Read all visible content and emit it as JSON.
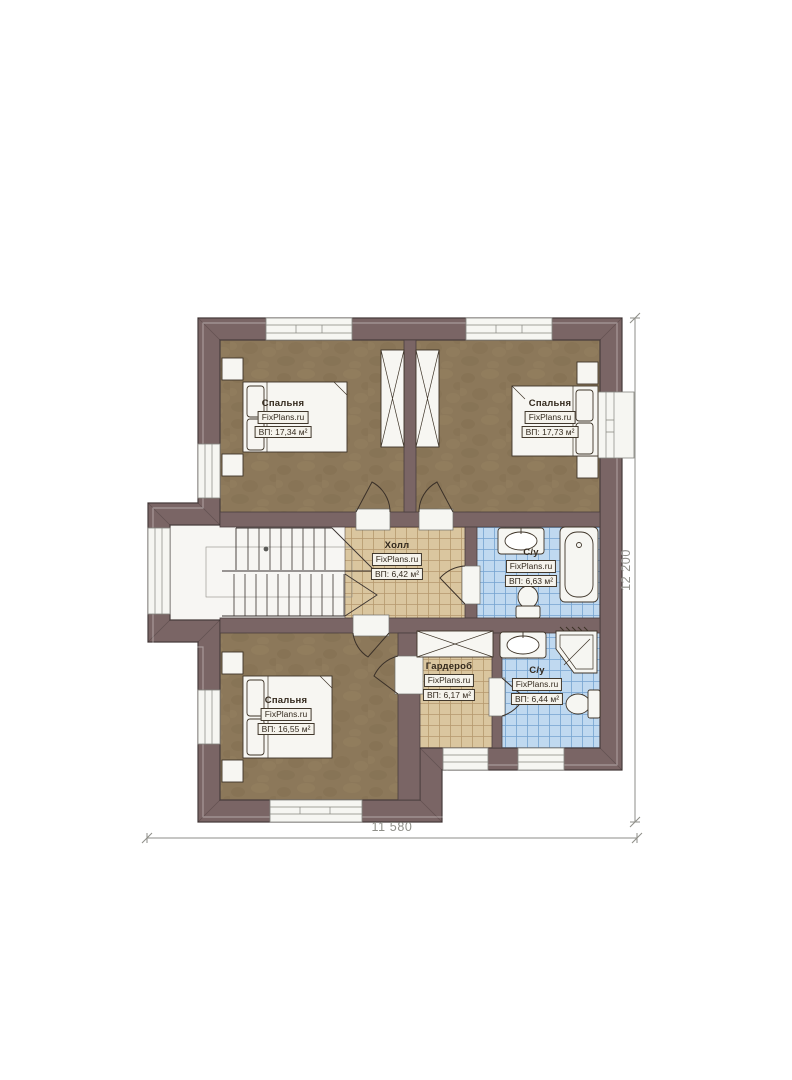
{
  "rooms": [
    {
      "id": "bedroom-top-left",
      "name": "Спальня",
      "brand": "FixPlans.ru",
      "area": "ВП: 17,34 м²"
    },
    {
      "id": "bedroom-top-right",
      "name": "Спальня",
      "brand": "FixPlans.ru",
      "area": "ВП: 17,73 м²"
    },
    {
      "id": "hall",
      "name": "Холл",
      "brand": "FixPlans.ru",
      "area": "ВП: 6,42 м²"
    },
    {
      "id": "bathroom-upper",
      "name": "С/у",
      "brand": "FixPlans.ru",
      "area": "ВП: 6,63 м²"
    },
    {
      "id": "bedroom-bottom",
      "name": "Спальня",
      "brand": "FixPlans.ru",
      "area": "ВП: 16,55 м²"
    },
    {
      "id": "wardrobe",
      "name": "Гардероб",
      "brand": "FixPlans.ru",
      "area": "ВП: 6,17 м²"
    },
    {
      "id": "bathroom-lower",
      "name": "С/у",
      "brand": "FixPlans.ru",
      "area": "ВП: 6,44 м²"
    }
  ],
  "dimensions": {
    "width_label": "11 580",
    "height_label": "12 200"
  },
  "symbols": [
    "bed",
    "nightstand",
    "wardrobe-closet",
    "stairs",
    "door-swing",
    "window",
    "sink",
    "bathtub",
    "toilet",
    "corner-shower"
  ],
  "colors": {
    "wall": "#7a6565",
    "bedroom_floor": "#8c785a",
    "tile_beige": "#dac69f",
    "tile_blue": "#c0d9f0",
    "room_white": "#f7f6f3",
    "dimension_text": "#8f8f89"
  }
}
